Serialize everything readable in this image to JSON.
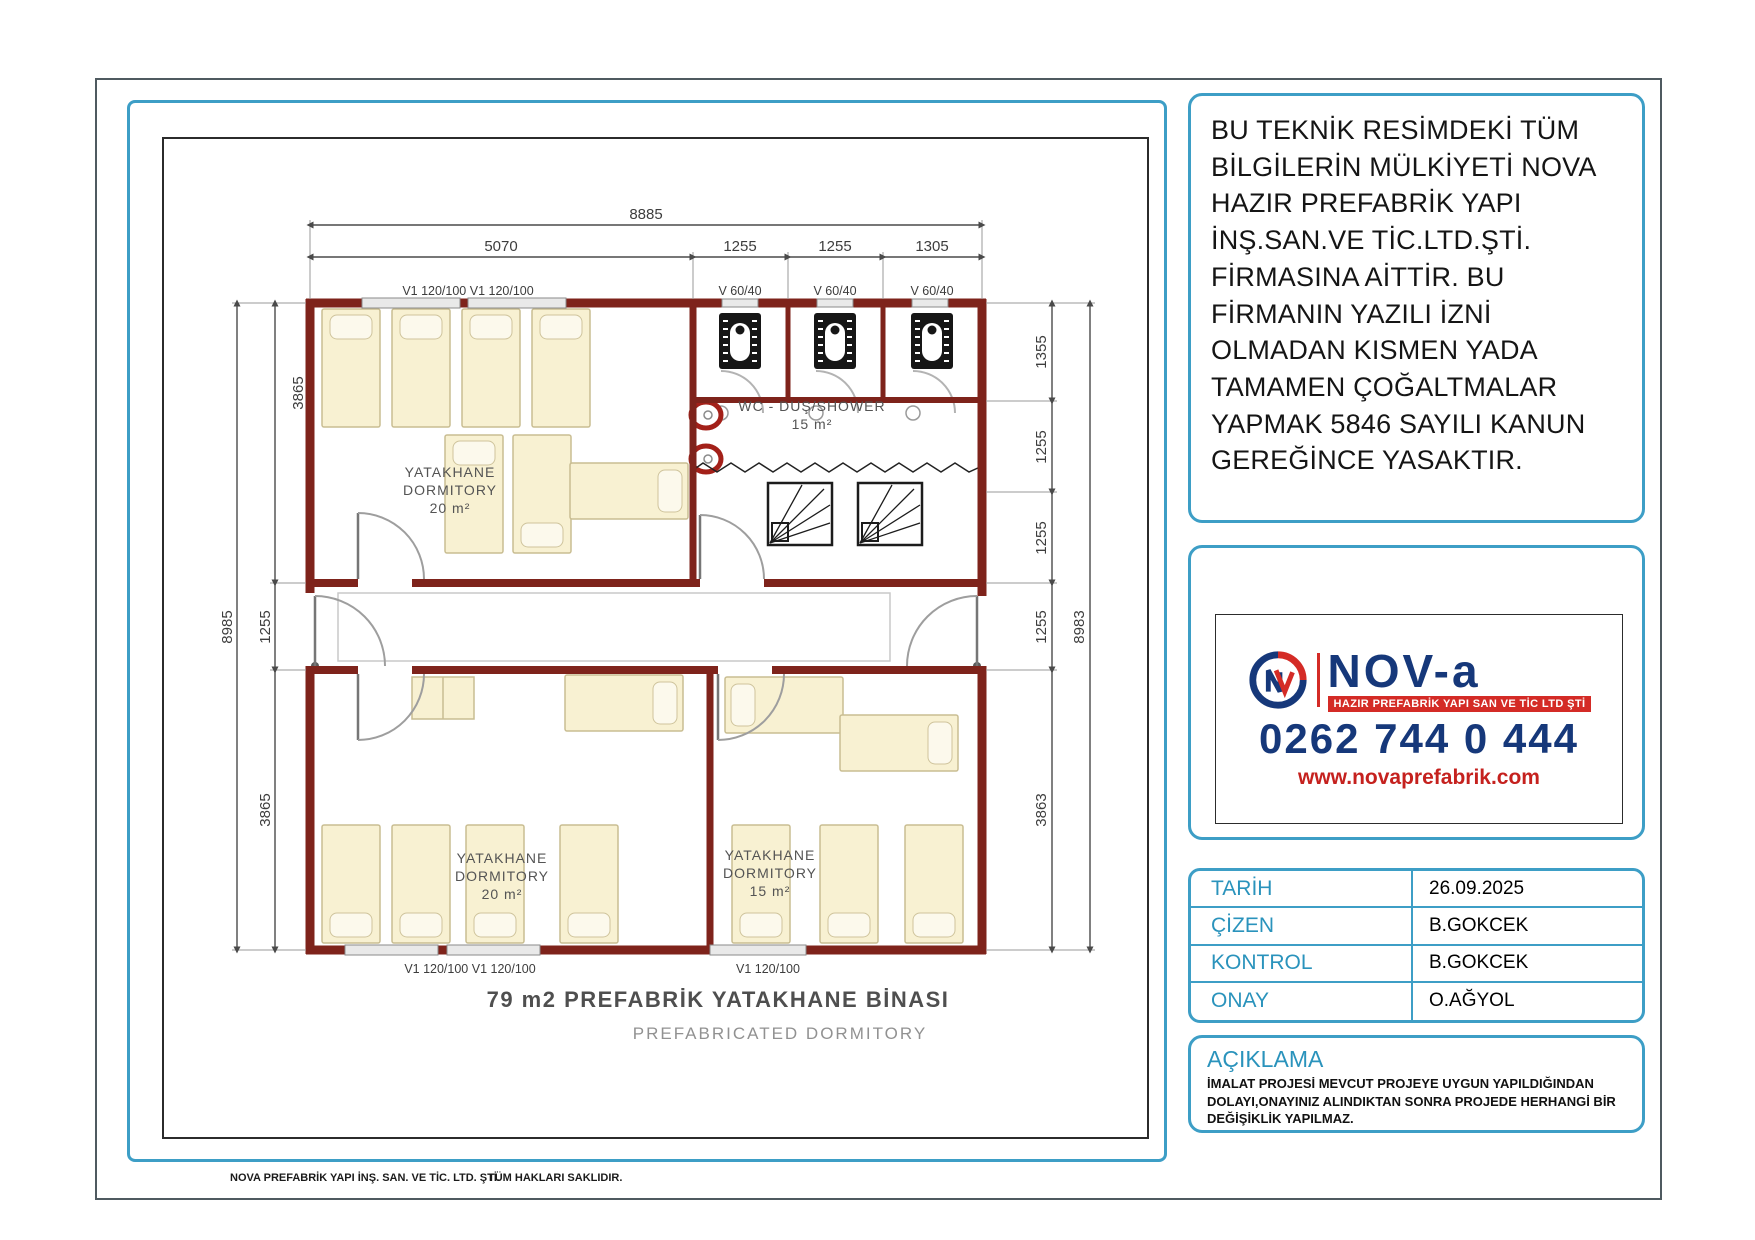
{
  "copyright_notice": "BU TEKNİK RESİMDEKİ TÜM BİLGİLERİN MÜLKİYETİ NOVA HAZIR PREFABRİK YAPI İNŞ.SAN.VE TİC.LTD.ŞTİ. FİRMASINA AİTTİR. BU FİRMANIN YAZILI İZNİ OLMADAN KISMEN YADA TAMAMEN ÇOĞALTMALAR YAPMAK 5846 SAYILI KANUN GEREĞİNCE YASAKTIR.",
  "logo": {
    "brand": "NOV-a",
    "tagline": "HAZIR PREFABRİK YAPI SAN VE TİC LTD ŞTİ",
    "phone": "0262 744 0 444",
    "website": "www.novaprefabrik.com",
    "navy": "#16387a",
    "red": "#d42b26"
  },
  "title_block": {
    "rows": [
      {
        "label": "TARİH",
        "value": "26.09.2025"
      },
      {
        "label": "ÇİZEN",
        "value": "B.GOKCEK"
      },
      {
        "label": "KONTROL",
        "value": "B.GOKCEK"
      },
      {
        "label": "ONAY",
        "value": "O.AĞYOL"
      }
    ]
  },
  "note": {
    "title": "AÇIKLAMA",
    "body": "İMALAT PROJESİ MEVCUT PROJEYE UYGUN YAPILDIĞINDAN DOLAYI,ONAYINIZ ALINDIKTAN SONRA PROJEDE HERHANGİ BİR DEĞİŞİKLİK YAPILMAZ."
  },
  "footer": {
    "company": "NOVA  PREFABRİK YAPI İNŞ. SAN. VE TİC. LTD. ŞTİ.",
    "rights": "TÜM HAKLARI SAKLIDIR."
  },
  "plan": {
    "title": "79 m2 PREFABRİK YATAKHANE BİNASI",
    "subtitle": "PREFABRICATED DORMITORY",
    "wall_color": "#7e231b",
    "dims": {
      "top_total": "8885",
      "top_segments": [
        "5070",
        "1255",
        "1255",
        "1305"
      ],
      "left_total": "8985",
      "left_segments": [
        "3865",
        "1255",
        "3865"
      ],
      "right_total": "8983",
      "right_segments": [
        "1355",
        "1255",
        "1255",
        "1255",
        "3863"
      ]
    },
    "windows": {
      "top_large": "V1 120/100 V1 120/100",
      "small": [
        "V 60/40",
        "V 60/40",
        "V 60/40"
      ],
      "bottom_left": "V1 120/100 V1 120/100",
      "bottom_right": "V1 120/100"
    },
    "rooms": [
      {
        "name": "YATAKHANE",
        "name_en": "DORMITORY",
        "area": "20 m²"
      },
      {
        "name": "WC - DUŞ/SHOWER",
        "area": "15 m²"
      },
      {
        "name": "YATAKHANE",
        "name_en": "DORMITORY",
        "area": "20 m²"
      },
      {
        "name": "YATAKHANE",
        "name_en": "DORMITORY",
        "area": "15 m²"
      }
    ]
  }
}
